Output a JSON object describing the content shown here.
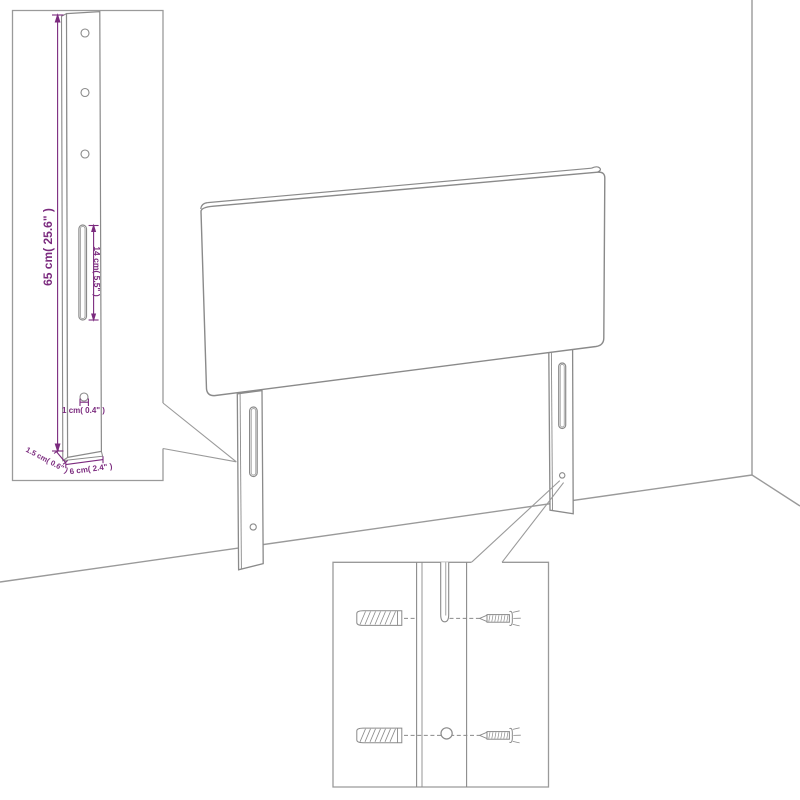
{
  "diagram": {
    "description": "Headboard with two mounting legs shown in a room corner, with a leg-dimension inset and a wall-mounting hardware inset",
    "dimensions": {
      "leg_height": "65 cm( 25.6\" )",
      "slot_length": "14 cm( 5.5\" )",
      "hole_diameter": "1 cm( 0.4\" )",
      "leg_depth": "1.5 cm( 0.6\" )",
      "leg_width": "6 cm( 2.4\" )"
    },
    "icons": {
      "wall_plug": "wall-plug-icon",
      "screw": "screw-icon"
    },
    "colors": {
      "outline": "#8a8a8a",
      "inset_border": "#9a9a9a",
      "dimension_text": "#7b2a7e",
      "background": "#ffffff"
    }
  }
}
